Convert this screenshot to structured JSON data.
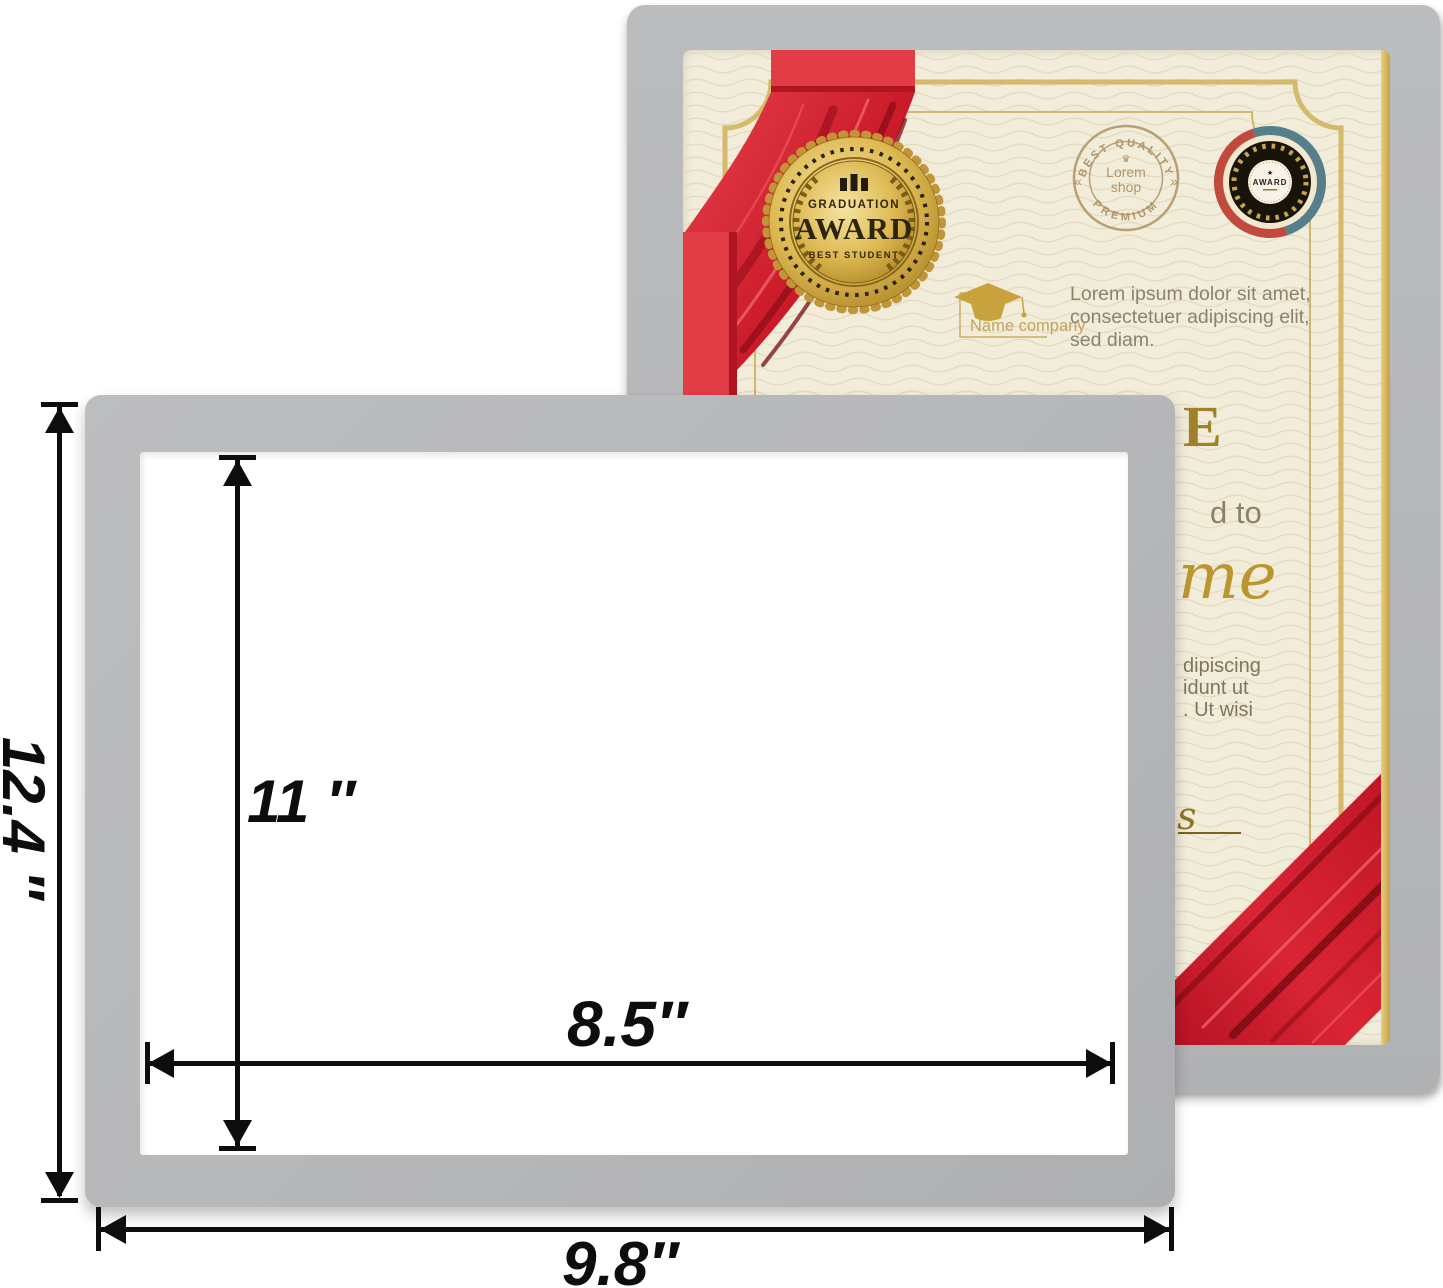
{
  "colors": {
    "frame_gray": "#b7b8ba",
    "certificate_cream": "#f2ecda",
    "ribbon_red": "#d6202e",
    "gold": "#c9a64c",
    "arrow_black": "#0d0d0d"
  },
  "certificate": {
    "seal": {
      "top": "GRADUATION",
      "main": "AWARD",
      "sub": "BEST STUDENT"
    },
    "stamp": {
      "arc_top": "BEST QUALITY",
      "crown": "♛",
      "center_line1": "Lorem",
      "center_line2": "shop",
      "arc_bottom": "PREMIUM",
      "left_mark": "«",
      "right_mark": "»"
    },
    "medal": {
      "star": "★",
      "label": "AWARD"
    },
    "company_name": "Name company",
    "intro_lines": [
      "Lorem ipsum dolor sit amet,",
      "consectetuer adipiscing elit,",
      "sed diam."
    ],
    "title_fragment": "E",
    "awarded_fragment": "d to",
    "recipient_fragment": "me",
    "body_fragments": [
      "dipiscing",
      "idunt ut",
      ". Ut wisi"
    ],
    "signature_fragment": "s"
  },
  "dimensions": {
    "outer_height_label": "12.4 ″",
    "inner_height_label": "11 ″",
    "inner_width_label": "8.5″",
    "outer_width_label": "9.8″"
  }
}
